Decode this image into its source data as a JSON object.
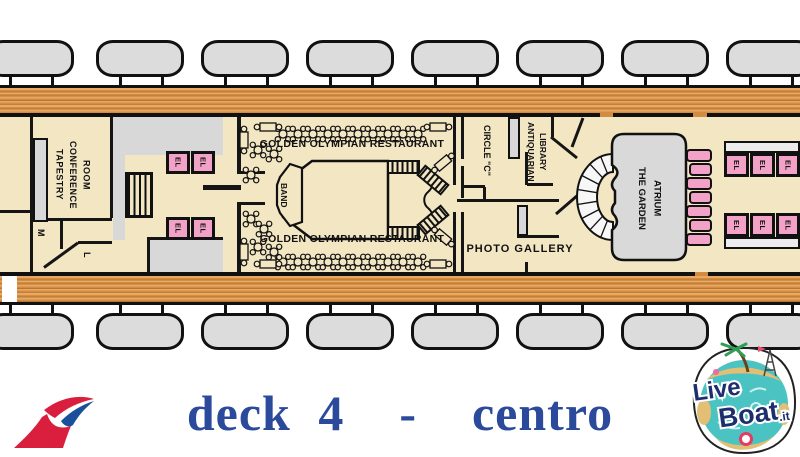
{
  "title": {
    "text": "deck 4  -  centro"
  },
  "plan": {
    "labels": {
      "tapestry": "TAPESTRY\nCONFERENCE\nROOM",
      "mens_room": "M",
      "ladies_room": "L",
      "elevator": "EL",
      "restaurant": "GOLDEN OLYMPIAN RESTAURANT",
      "band": "BAND",
      "circle_c": "CIRCLE \"C\"",
      "library": "ANTIQUARIAN\nLIBRARY",
      "photo_gallery": "PHOTO GALLERY",
      "atrium": "THE GARDEN\nATRIUM"
    },
    "colors": {
      "room_fill": "#f2e6c3",
      "corridor_fill": "#d8d8d8",
      "elevator_pink": "#f2a2c6",
      "wood_deck": "#d18c42",
      "lifeboat_grey": "#dcdcdc",
      "wall_black": "#151515",
      "title_blue": "#2b4a9b"
    }
  },
  "logos": {
    "liveboat": {
      "live": "Live",
      "boat": "Boat",
      "it": ".it"
    }
  }
}
